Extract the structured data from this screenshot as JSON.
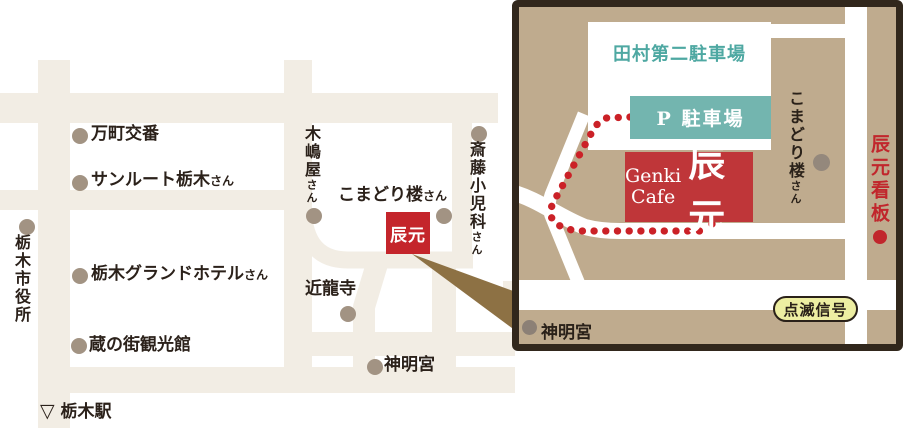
{
  "left": {
    "manmachi": "万町交番",
    "sunroute": "サンルート栃木",
    "sunroute_suffix": "さん",
    "cityhall": "栃木市役所",
    "grandhotel": "栃木グランドホテル",
    "grandhotel_suffix": "さん",
    "kuranomachi": "蔵の街観光館",
    "station_mark": "▽",
    "station": "栃木駅",
    "kijimaya": "木嶋屋",
    "kijimaya_suffix": "さん",
    "komadori": "こまどり楼",
    "komadori_suffix": "さん",
    "saito": "斎藤小児科",
    "saito_suffix": "さん",
    "tatsumoto": "辰元",
    "kinryuji": "近龍寺",
    "shinmeigu": "神明宮"
  },
  "detail": {
    "lot_name": "田村第二駐車場",
    "p_lot": "P 駐車場",
    "cafe_en_line1": "Genki",
    "cafe_en_line2": "Cafe",
    "cafe_jp": "辰元",
    "komadori": "こまどり楼",
    "komadori_suffix": "さん",
    "sign": "辰元看板",
    "signal": "点滅信号",
    "shinmeigu": "神明宮"
  },
  "colors": {
    "road_cream": "#f2ede4",
    "panel_tan": "#bfab8e",
    "panel_border": "#31271c",
    "accent_red": "#c4252b",
    "cafe_red": "#bf3639",
    "teal_box": "#73b5af",
    "teal_text": "#4ea8a2",
    "poi_dot": "#a29383",
    "route_red": "#cb2127",
    "signal_bg": "#edeea2",
    "ink": "#2b211a",
    "pointer_wedge": "#8d7144"
  }
}
